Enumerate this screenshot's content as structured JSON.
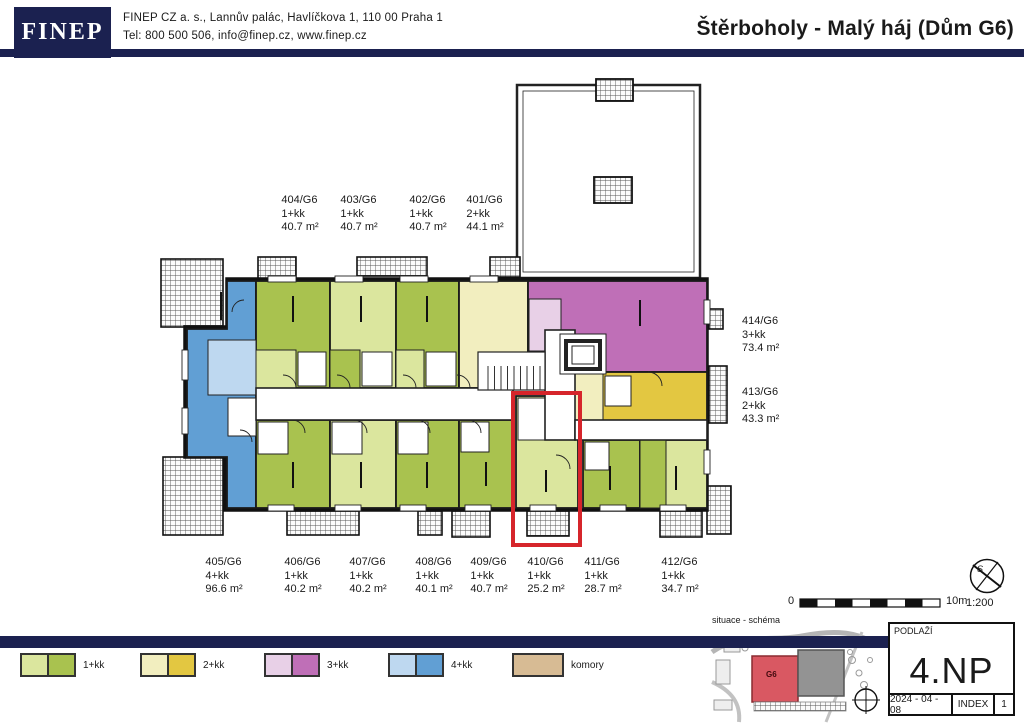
{
  "colors": {
    "navy": "#1b2150",
    "red": "#d6252b",
    "g1l": "#dbe69e",
    "g1d": "#a9c24f",
    "g2l": "#f2eebf",
    "g2d": "#e3c741",
    "g3l": "#e8d0e7",
    "g3d": "#bf6fb7",
    "g4l": "#bed8f0",
    "g4d": "#619fd4",
    "tan": "#d7bb94"
  },
  "header": {
    "logo": "FINEP",
    "address_line": "FINEP CZ a. s., Lannův palác, Havlíčkova 1, 110 00   Praha  1",
    "contact_line": "Tel: 800 500 506, info@finep.cz, www.finep.cz",
    "title": "Štěrboholy - Malý háj (Dům G6)"
  },
  "apartments": [
    {
      "id": "404/G6",
      "type": "1+kk",
      "area": "40.7 m²"
    },
    {
      "id": "403/G6",
      "type": "1+kk",
      "area": "40.7 m²"
    },
    {
      "id": "402/G6",
      "type": "1+kk",
      "area": "40.7 m²"
    },
    {
      "id": "401/G6",
      "type": "2+kk",
      "area": "44.1 m²"
    },
    {
      "id": "414/G6",
      "type": "3+kk",
      "area": "73.4 m²"
    },
    {
      "id": "413/G6",
      "type": "2+kk",
      "area": "43.3 m²"
    },
    {
      "id": "405/G6",
      "type": "4+kk",
      "area": "96.6 m²"
    },
    {
      "id": "406/G6",
      "type": "1+kk",
      "area": "40.2 m²"
    },
    {
      "id": "407/G6",
      "type": "1+kk",
      "area": "40.2 m²"
    },
    {
      "id": "408/G6",
      "type": "1+kk",
      "area": "40.1 m²"
    },
    {
      "id": "409/G6",
      "type": "1+kk",
      "area": "40.7 m²"
    },
    {
      "id": "410/G6",
      "type": "1+kk",
      "area": "25.2 m²"
    },
    {
      "id": "411/G6",
      "type": "1+kk",
      "area": "28.7 m²"
    },
    {
      "id": "412/G6",
      "type": "1+kk",
      "area": "34.7 m²"
    }
  ],
  "scalebar": {
    "zero": "0",
    "max": "10m",
    "ratio": "1:200",
    "compass_letter": "S"
  },
  "legend": {
    "items": [
      {
        "label": "1+kk",
        "light": "#dbe69e",
        "dark": "#a9c24f"
      },
      {
        "label": "2+kk",
        "light": "#f2eebf",
        "dark": "#e3c741"
      },
      {
        "label": "3+kk",
        "light": "#e8d0e7",
        "dark": "#bf6fb7"
      },
      {
        "label": "4+kk",
        "light": "#bed8f0",
        "dark": "#619fd4"
      }
    ],
    "komory": {
      "label": "komory",
      "color": "#d7bb94"
    }
  },
  "footer": {
    "situace_label": "situace - schéma",
    "building_label": "G6",
    "floor_caption": "PODLAŽÍ",
    "floor": "4.NP",
    "date": "2024 - 04 - 08",
    "index_label": "INDEX",
    "index_value": "1"
  }
}
